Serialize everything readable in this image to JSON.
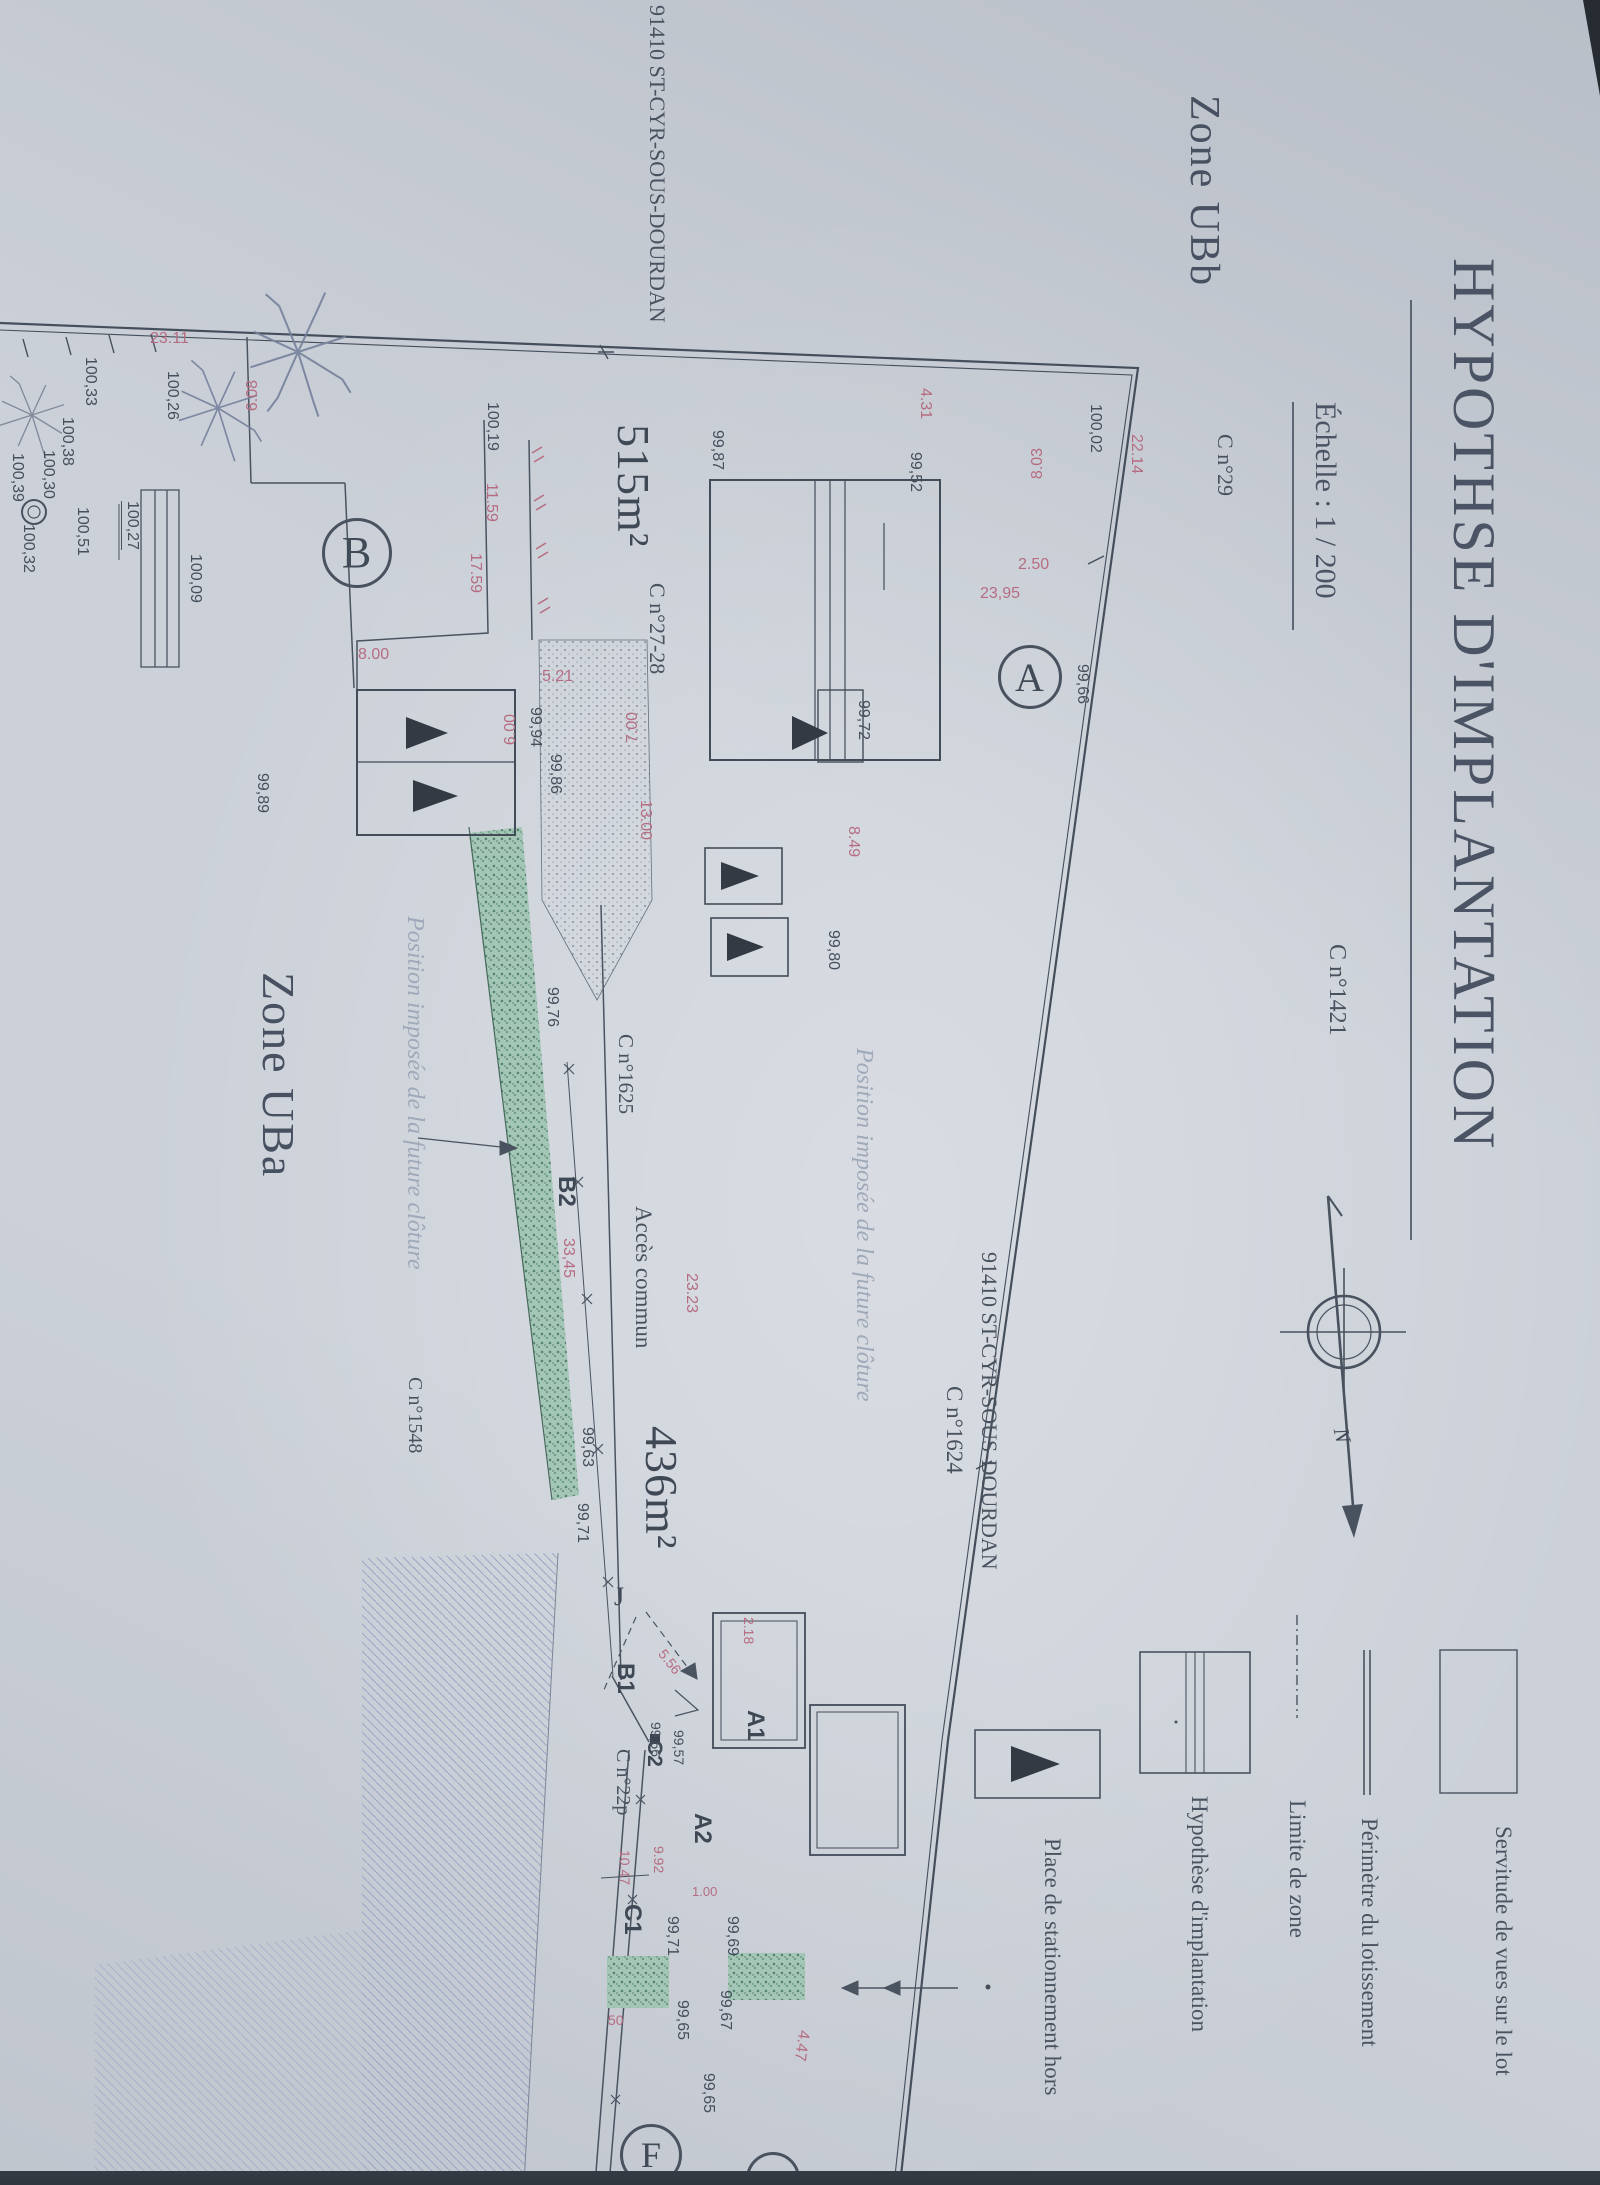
{
  "title": {
    "main": "HYPOTHSE D'IMPLANTATION",
    "scale": "Échelle : 1 / 200"
  },
  "zones": {
    "ubb": "Zone UBb",
    "uba": "Zone UBa"
  },
  "legend": {
    "servitude": "Servitude de vues sur le lot",
    "perimetre": "Périmètre du lotissement",
    "limite": "Limite de zone",
    "hypothese": "Hypothèse d'implantation",
    "stationnement": "Place de stationnement hors"
  },
  "parcels": {
    "area_a": "515m²",
    "area_b": "436m²",
    "letter_a": "A",
    "letter_b": "B",
    "letter_f": "F",
    "access": "Accès commun"
  },
  "cadastre": {
    "commune": "91410 ST-CYR-SOUS-DOURDAN",
    "c29": "C n°29",
    "c1421": "C n°1421",
    "c1624": "C n°1624",
    "c1625": "C n°1625",
    "c1548": "C n°1548",
    "c2728": "C n°27-28",
    "c22p": "C n°22p"
  },
  "points": {
    "a1": "A1",
    "a2": "A2",
    "b1": "B1",
    "b2": "B2",
    "c1": "C1",
    "c2": "C2"
  },
  "notes": {
    "fence": "Position imposée de la future clôture",
    "north": "N",
    "leader_j": "J"
  },
  "elevations": [
    "100,02",
    "99,66",
    "99,52",
    "99,87",
    "99,72",
    "99,80",
    "99,63",
    "99,71",
    "99,76",
    "99,94",
    "99,86",
    "99,89",
    "100,19",
    "100,26",
    "100,33",
    "100,38",
    "100,30",
    "100,39",
    "100,32",
    "100,51",
    "100,27",
    "100,09",
    "99,57",
    "99,56",
    "99,71",
    "99,69",
    "99,67",
    "99,65",
    "99,65"
  ],
  "dimensions": [
    "23.11",
    "6.08",
    "22.14",
    "4.31",
    "8.03",
    "23,95",
    "2.50",
    "8.49",
    "13.00",
    "7.00",
    "5.21",
    "6.00",
    "8.00",
    "11.59",
    "17.59",
    "33,45",
    "23.23",
    "5.56",
    "2.18",
    "9.92",
    "1.00",
    "10.47",
    "4.47",
    "50"
  ],
  "colors": {
    "paper": "#ccd1d9",
    "ink": "#454e5b",
    "pink": "#b66d81",
    "pale": "#9fa9b9",
    "green": "#7fae9c",
    "hatch": "#9aa3c4"
  }
}
